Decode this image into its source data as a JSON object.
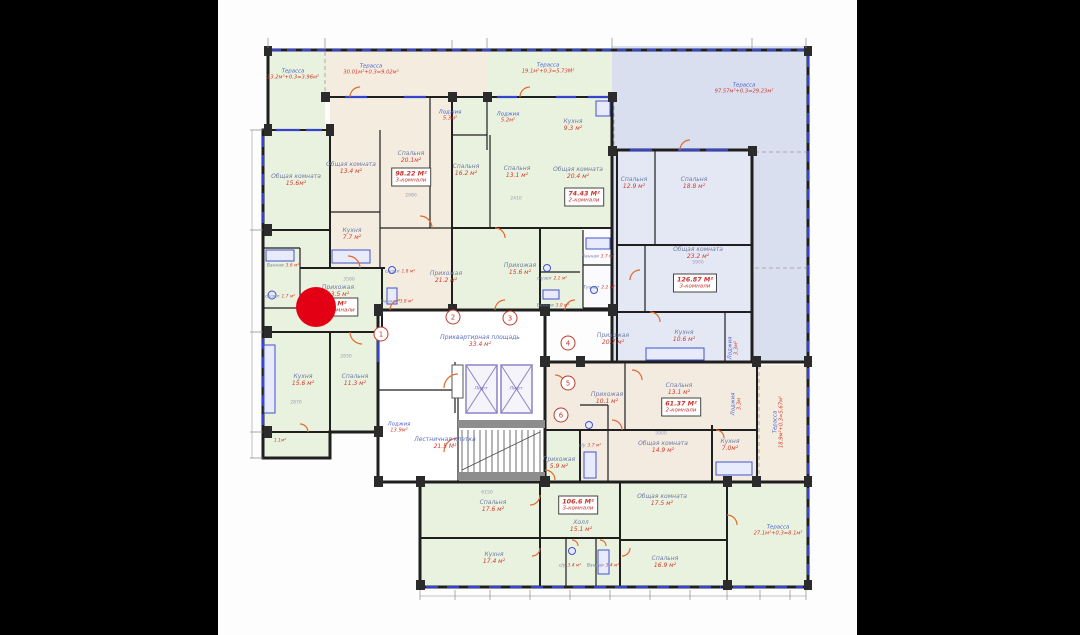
{
  "marker": {
    "x": 316,
    "y": 307,
    "diameter": 40,
    "color": "#e30015"
  },
  "labels": [
    {
      "type": "terr",
      "name": "Терасса",
      "area": "13.2м²+0.3=3.96м²",
      "x": 293,
      "y": 75
    },
    {
      "type": "terr",
      "name": "Терасса",
      "area": "30.01м²+0.3=9.02м²",
      "x": 371,
      "y": 70
    },
    {
      "type": "terr",
      "name": "Терасса",
      "area": "19.1м²+0.3=5.73М²",
      "x": 548,
      "y": 69
    },
    {
      "type": "terr",
      "name": "Терасса",
      "area": "97.57м²+0.3=29.23м²",
      "x": 744,
      "y": 89
    },
    {
      "type": "terr",
      "name": "Терасса",
      "area": "18.9м²+0.3=5.67м²",
      "x": 779,
      "y": 422,
      "rot": -90
    },
    {
      "type": "terr",
      "name": "Терасса",
      "area": "27.1м²+0.3=8.1м²",
      "x": 778,
      "y": 531
    },
    {
      "type": "terr",
      "name": "Лоджия",
      "area": "5.3м²",
      "x": 450,
      "y": 116
    },
    {
      "type": "terr",
      "name": "Лоджия",
      "area": "5.2м²",
      "x": 508,
      "y": 118
    },
    {
      "type": "terr",
      "name": "Лоджия",
      "area": "3.3м²",
      "x": 734,
      "y": 348,
      "rot": -90
    },
    {
      "type": "terr",
      "name": "Лоджия",
      "area": "3.3м",
      "x": 737,
      "y": 404,
      "rot": -90
    },
    {
      "type": "terr",
      "name": "Лоджия",
      "area": "13.9м²",
      "x": 399,
      "y": 428
    },
    {
      "type": "room",
      "name": "Общая комната",
      "area": "15.6м²",
      "x": 296,
      "y": 180
    },
    {
      "type": "room",
      "name": "Общая комната",
      "area": "13.4 м²",
      "x": 351,
      "y": 168
    },
    {
      "type": "room",
      "name": "Спальня",
      "area": "20.1м²",
      "x": 411,
      "y": 157
    },
    {
      "type": "room",
      "name": "Кухня",
      "area": "7.7 м²",
      "x": 352,
      "y": 234
    },
    {
      "type": "room",
      "name": "Прихожая",
      "area": "21.2 м²",
      "x": 446,
      "y": 277
    },
    {
      "type": "room",
      "name": "Спальня",
      "area": "16.2 м²",
      "x": 466,
      "y": 170
    },
    {
      "type": "room",
      "name": "Спальня",
      "area": "13.1 м²",
      "x": 517,
      "y": 172
    },
    {
      "type": "room",
      "name": "Кухня",
      "area": "9.3 м²",
      "x": 573,
      "y": 125
    },
    {
      "type": "room",
      "name": "Общая комната",
      "area": "20.4 м²",
      "x": 578,
      "y": 173
    },
    {
      "type": "room",
      "name": "Прихожая",
      "area": "15.6 м²",
      "x": 520,
      "y": 269
    },
    {
      "type": "room",
      "name": "Прихожая",
      "area": "13.5 м²",
      "x": 338,
      "y": 291
    },
    {
      "type": "room",
      "name": "Кухня",
      "area": "15.6 м²",
      "x": 303,
      "y": 380
    },
    {
      "type": "room",
      "name": "Спальня",
      "area": "11.3 м²",
      "x": 355,
      "y": 380
    },
    {
      "type": "room",
      "name": "Спальня",
      "area": "12.9 м²",
      "x": 634,
      "y": 183
    },
    {
      "type": "room",
      "name": "Спальня",
      "area": "18.8 м²",
      "x": 694,
      "y": 183
    },
    {
      "type": "room",
      "name": "Общая комната",
      "area": "23.2 м²",
      "x": 698,
      "y": 253
    },
    {
      "type": "room",
      "name": "Кухня",
      "area": "10.6 м²",
      "x": 684,
      "y": 336
    },
    {
      "type": "room",
      "name": "Прихожая",
      "area": "20.7 м²",
      "x": 613,
      "y": 339
    },
    {
      "type": "room",
      "name": "Прихожая",
      "area": "10.1 м²",
      "x": 607,
      "y": 398
    },
    {
      "type": "room",
      "name": "Спальня",
      "area": "13.1 м²",
      "x": 679,
      "y": 389
    },
    {
      "type": "room",
      "name": "Общая комната",
      "area": "14.9 м²",
      "x": 663,
      "y": 447
    },
    {
      "type": "room",
      "name": "Кухня",
      "area": "7.0м²",
      "x": 730,
      "y": 445
    },
    {
      "type": "room",
      "name": "Спальня",
      "area": "17.6 м²",
      "x": 493,
      "y": 506
    },
    {
      "type": "room",
      "name": "Холл",
      "area": "15.1 м²",
      "x": 581,
      "y": 526
    },
    {
      "type": "room",
      "name": "Общая комната",
      "area": "17.5 м²",
      "x": 662,
      "y": 500
    },
    {
      "type": "room",
      "name": "Кухня",
      "area": "17.4 м²",
      "x": 494,
      "y": 558
    },
    {
      "type": "room",
      "name": "Спальня",
      "area": "16.9 м²",
      "x": 665,
      "y": 562
    },
    {
      "type": "room",
      "name": "Прихожая",
      "area": "5.9 м²",
      "x": 559,
      "y": 463
    },
    {
      "type": "tiny",
      "name": "Ванная",
      "area": "3.6 м²",
      "x": 283,
      "y": 261
    },
    {
      "type": "tiny",
      "name": "с/узел",
      "area": "1.7 м²",
      "x": 280,
      "y": 292
    },
    {
      "type": "tiny",
      "name": "с/узел",
      "area": "1.8 м²",
      "x": 400,
      "y": 267
    },
    {
      "type": "tiny",
      "name": "Ванная",
      "area": "3.8 м²",
      "x": 397,
      "y": 297
    },
    {
      "type": "tiny",
      "name": "с/узел",
      "area": "2.1 м²",
      "x": 552,
      "y": 274
    },
    {
      "type": "tiny",
      "name": "Ванная",
      "area": "3.0 м²",
      "x": 553,
      "y": 301
    },
    {
      "type": "tiny",
      "name": "Ванная",
      "area": "3.7 м²",
      "x": 598,
      "y": 252
    },
    {
      "type": "tiny",
      "name": "Туалет",
      "area": "2.2 м²",
      "x": 599,
      "y": 283
    },
    {
      "type": "tiny",
      "name": "с/у",
      "area": "3.7 м²",
      "x": 590,
      "y": 441
    },
    {
      "type": "tiny",
      "name": "с/у",
      "area": "3.4 м²",
      "x": 570,
      "y": 561
    },
    {
      "type": "tiny",
      "name": "Ванная",
      "area": "3.4 м²",
      "x": 603,
      "y": 561
    },
    {
      "type": "tiny",
      "name": "",
      "area": "1.1м²",
      "x": 279,
      "y": 436
    },
    {
      "type": "core",
      "name": "Приквартирная площадь",
      "area": "33.4 м²",
      "x": 480,
      "y": 341
    },
    {
      "type": "core",
      "name": "Лестничная клетка",
      "area": "21.5 М²",
      "x": 445,
      "y": 443
    },
    {
      "type": "lift",
      "name": "Лифт",
      "area": "",
      "x": 481,
      "y": 389
    },
    {
      "type": "lift",
      "name": "Лифт",
      "area": "",
      "x": 516,
      "y": 389
    }
  ],
  "units": [
    {
      "area": "98.22 М²",
      "rooms": "3-комнали",
      "x": 411,
      "y": 177
    },
    {
      "area": "74.43 М²",
      "rooms": "2-комнали",
      "x": 584,
      "y": 197
    },
    {
      "area": "126.87 М²",
      "rooms": "3-комнали",
      "x": 695,
      "y": 283
    },
    {
      "area": "61.37 М²",
      "rooms": "2-комнали",
      "x": 681,
      "y": 407
    },
    {
      "area": "106.6 М²",
      "rooms": "3-комнали",
      "x": 578,
      "y": 505
    },
    {
      "area": "М²",
      "rooms": "комнали",
      "x": 342,
      "y": 307
    }
  ],
  "dims": [
    {
      "text": "2980",
      "x": 411,
      "y": 196
    },
    {
      "text": "3580",
      "x": 349,
      "y": 280
    },
    {
      "text": "2830",
      "x": 346,
      "y": 357
    },
    {
      "text": "2870",
      "x": 296,
      "y": 403
    },
    {
      "text": "5900",
      "x": 698,
      "y": 263
    },
    {
      "text": "6150",
      "x": 487,
      "y": 493
    },
    {
      "text": "5900",
      "x": 661,
      "y": 434
    },
    {
      "text": "2410",
      "x": 516,
      "y": 199
    }
  ],
  "axis_bubbles": [
    {
      "n": "1",
      "x": 381,
      "y": 334
    },
    {
      "n": "2",
      "x": 453,
      "y": 317
    },
    {
      "n": "3",
      "x": 510,
      "y": 318
    },
    {
      "n": "4",
      "x": 568,
      "y": 343
    },
    {
      "n": "5",
      "x": 568,
      "y": 383
    },
    {
      "n": "6",
      "x": 561,
      "y": 415
    }
  ]
}
